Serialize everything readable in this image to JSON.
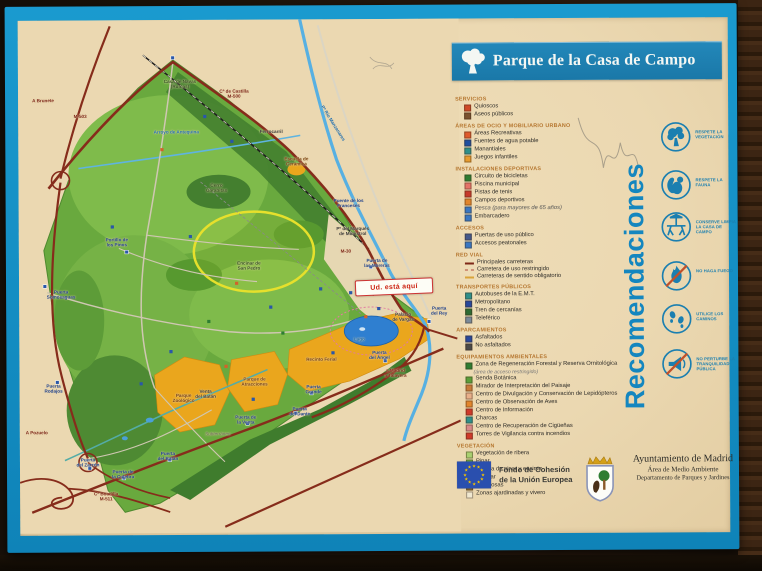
{
  "sign": {
    "title": "Parque de la Casa de Campo"
  },
  "you_are_here": "Ud. está aquí",
  "colors": {
    "frame_blue": "#1590c4",
    "panel_cream": "#ebd8b1",
    "banner_blue": "#1e7fb2",
    "park_green": "#69a93e",
    "park_dark_green": "#3f7c2d",
    "orange_zone": "#eaa61d",
    "road_maroon": "#862c1b",
    "river_blue": "#57b0e2",
    "lake_blue": "#2f7fd0",
    "bike_loop_yellow": "#e6e02c",
    "legend_header": "#b5762f",
    "recomendaciones_blue": "#1486bf"
  },
  "recommendations": {
    "heading": "Recomendaciones",
    "items": [
      {
        "icon": "tree-icon",
        "label": "RESPETE LA VEGETACIÓN"
      },
      {
        "icon": "squirrel-icon",
        "label": "RESPETE LA FAUNA"
      },
      {
        "icon": "picnic-table-icon",
        "label": "CONSERVE LIMPIA LA CASA DE CAMPO"
      },
      {
        "icon": "no-fire-icon",
        "label": "NO HAGA FUEGO"
      },
      {
        "icon": "footprints-icon",
        "label": "UTILICE LOS CAMINOS"
      },
      {
        "icon": "no-noise-icon",
        "label": "NO PERTURBE LA TRANQUILIDAD PÚBLICA"
      }
    ]
  },
  "legend": {
    "sections": [
      {
        "title": "SERVICIOS",
        "items": [
          {
            "label": "Quioscos",
            "color": "#cf4a28",
            "sw": "sq"
          },
          {
            "label": "Aseos públicos",
            "color": "#7a5230",
            "sw": "sq"
          }
        ]
      },
      {
        "title": "ÁREAS DE OCIO Y MOBILIARIO URBANO",
        "items": [
          {
            "label": "Áreas Recreativas",
            "color": "#df5a2c",
            "sw": "sq"
          },
          {
            "label": "Fuentes de agua potable",
            "color": "#1f4fa0",
            "sw": "sq"
          },
          {
            "label": "Manantiales",
            "color": "#2e8f8a",
            "sw": "sq"
          },
          {
            "label": "Juegos infantiles",
            "color": "#e79b2e",
            "sw": "sq"
          }
        ]
      },
      {
        "title": "INSTALACIONES DEPORTIVAS",
        "items": [
          {
            "label": "Circuito de bicicletas",
            "color": "#2e7d32",
            "sw": "sq"
          },
          {
            "label": "Piscina municipal",
            "color": "#e57368",
            "sw": "sq"
          },
          {
            "label": "Pistas de tenis",
            "color": "#c6392b",
            "sw": "sq"
          },
          {
            "label": "Campos deportivos",
            "color": "#e2862d",
            "sw": "sq"
          },
          {
            "label": "Pesca (para mayores de 65 años)",
            "color": "#3a77c2",
            "sw": "sq",
            "italic": true
          },
          {
            "label": "Embarcadero",
            "color": "#3a77c2",
            "sw": "sq"
          }
        ]
      },
      {
        "title": "ACCESOS",
        "items": [
          {
            "label": "Puertas de uso público",
            "color": "#44598c",
            "sw": "sq"
          },
          {
            "label": "Accesos peatonales",
            "color": "#3a77c2",
            "sw": "sq"
          }
        ]
      },
      {
        "title": "RED VIAL",
        "items": [
          {
            "label": "Principales carreteras",
            "color": "#7e2817",
            "sw": "line"
          },
          {
            "label": "Carretera de uso restringido",
            "color": "#b0483a",
            "sw": "dash"
          },
          {
            "label": "Carreteras de sentido obligatorio",
            "color": "#d9a43a",
            "sw": "line"
          }
        ]
      },
      {
        "title": "TRANSPORTES PÚBLICOS",
        "items": [
          {
            "label": "Autobuses de la E.M.T.",
            "color": "#2e8f8a",
            "sw": "sq"
          },
          {
            "label": "Metropolitano",
            "color": "#28489c",
            "sw": "sq"
          },
          {
            "label": "Tren de cercanías",
            "color": "#2e6b34",
            "sw": "sq"
          },
          {
            "label": "Teleférico",
            "color": "#7a8a9a",
            "sw": "sq"
          }
        ]
      },
      {
        "title": "APARCAMIENTOS",
        "items": [
          {
            "label": "Asfaltados",
            "color": "#28489c",
            "sw": "sq"
          },
          {
            "label": "No asfaltados",
            "color": "#4a4a4a",
            "sw": "sq"
          }
        ]
      },
      {
        "title": "EQUIPAMIENTOS AMBIENTALES",
        "items": [
          {
            "label": "Zona de Regeneración Forestal y Reserva Ornitológica",
            "sub": "(área de acceso restringido)",
            "color": "#2e7d32",
            "sw": "sq"
          },
          {
            "label": "Senda Botánica",
            "color": "#5a9e3a",
            "sw": "sq"
          },
          {
            "label": "Mirador de Interpretación del Paisaje",
            "color": "#c77a3a",
            "sw": "sq"
          },
          {
            "label": "Centro de Divulgación y Conservación de Lepidópteros",
            "color": "#e8b08a",
            "sw": "sq"
          },
          {
            "label": "Centro de Observación de Aves",
            "color": "#e2862d",
            "sw": "sq"
          },
          {
            "label": "Centro de Información",
            "color": "#cf3a2a",
            "sw": "sq"
          },
          {
            "label": "Charcas",
            "color": "#2e8f8a",
            "sw": "sq"
          },
          {
            "label": "Centro de Recuperación de Cigüeñas",
            "color": "#d88a8a",
            "sw": "sq"
          },
          {
            "label": "Torres de Vigilancia contra incendios",
            "color": "#cf3a2a",
            "sw": "sq"
          }
        ]
      },
      {
        "title": "VEGETACIÓN",
        "items": [
          {
            "label": "Vegetación de ribera",
            "color": "#a8d070",
            "sw": "sq"
          },
          {
            "label": "Pinar",
            "color": "#74b044",
            "sw": "sq"
          },
          {
            "label": "Mezcla de pinar y encinar",
            "color": "#549a38",
            "sw": "sq"
          },
          {
            "label": "Encinar",
            "color": "#2f7a2c",
            "sw": "sq"
          },
          {
            "label": "Frondosas",
            "color": "#8a6a2e",
            "sw": "sq"
          },
          {
            "label": "Zonas ajardinadas y vivero",
            "color": "#f0e8d0",
            "sw": "sq"
          }
        ]
      }
    ]
  },
  "map": {
    "labels": [
      {
        "t": "A Brunete",
        "x": 25,
        "y": 80,
        "c": "road"
      },
      {
        "t": "M-503",
        "x": 62,
        "y": 96,
        "c": "road"
      },
      {
        "t": "Cª de Castilla\nM-500",
        "x": 216,
        "y": 74,
        "c": "road"
      },
      {
        "t": "Casa de Navas\n(Ruinas)",
        "x": 162,
        "y": 64,
        "c": "area"
      },
      {
        "t": "Arroyo de Antequina",
        "x": 158,
        "y": 112,
        "c": "water"
      },
      {
        "t": "Ferrocarril",
        "x": 253,
        "y": 112,
        "c": "dark"
      },
      {
        "t": "Pª Río Manzanares",
        "x": 315,
        "y": 104,
        "c": "water",
        "r": 58
      },
      {
        "t": "Puente de los\nFranceses",
        "x": 330,
        "y": 184,
        "c": "gate"
      },
      {
        "t": "Pº del Marqués\nde Monistrol",
        "x": 334,
        "y": 212,
        "c": "dark"
      },
      {
        "t": "M-30",
        "x": 327,
        "y": 232,
        "c": "road"
      },
      {
        "t": "Puerta de\nlas Moreras",
        "x": 358,
        "y": 244,
        "c": "gate"
      },
      {
        "t": "Portillo de\nlos Pinos",
        "x": 98,
        "y": 222,
        "c": "gate"
      },
      {
        "t": "Puerta\nSomosaguas",
        "x": 42,
        "y": 274,
        "c": "gate"
      },
      {
        "t": "Encinar de\nSan Pedro",
        "x": 230,
        "y": 246,
        "c": "area"
      },
      {
        "t": "Cerro\nGarabitas",
        "x": 198,
        "y": 168,
        "c": "area"
      },
      {
        "t": "Escuela de\nCerámica",
        "x": 278,
        "y": 142,
        "c": "zone"
      },
      {
        "t": "Viveros\nMunicipales",
        "x": 352,
        "y": 272,
        "c": "dark"
      },
      {
        "t": "Palacio\nde Vargas",
        "x": 384,
        "y": 298,
        "c": "dark"
      },
      {
        "t": "Puerta\ndel Rey",
        "x": 420,
        "y": 292,
        "c": "gate"
      },
      {
        "t": "Lago",
        "x": 340,
        "y": 320,
        "c": "water"
      },
      {
        "t": "Puerta\ndel Ángel",
        "x": 360,
        "y": 336,
        "c": "gate"
      },
      {
        "t": "a Madrid\na Talavera",
        "x": 376,
        "y": 354,
        "c": "road"
      },
      {
        "t": "Parque\nZoológico",
        "x": 164,
        "y": 378,
        "c": "zone"
      },
      {
        "t": "Parque de\nAtracciones",
        "x": 235,
        "y": 362,
        "c": "zone"
      },
      {
        "t": "Recinto Ferial",
        "x": 302,
        "y": 340,
        "c": "zone"
      },
      {
        "t": "Puerta\nGrande",
        "x": 294,
        "y": 370,
        "c": "gate"
      },
      {
        "t": "Puerta\ndel Dante",
        "x": 280,
        "y": 392,
        "c": "gate"
      },
      {
        "t": "Puerta de\nla Venta",
        "x": 226,
        "y": 400,
        "c": "gate"
      },
      {
        "t": "Venta\ndel Batán",
        "x": 186,
        "y": 374,
        "c": "dark"
      },
      {
        "t": "Subterráneo",
        "x": 198,
        "y": 414,
        "c": "note"
      },
      {
        "t": "Puerta\ndel Batán",
        "x": 148,
        "y": 436,
        "c": "gate"
      },
      {
        "t": "Puerta\nRodajos",
        "x": 34,
        "y": 368,
        "c": "gate"
      },
      {
        "t": "Puerta\ndel Zarzón",
        "x": 68,
        "y": 442,
        "c": "gate"
      },
      {
        "t": "Puerta de\nla Culebra",
        "x": 103,
        "y": 454,
        "c": "gate"
      },
      {
        "t": "A Pozuelo",
        "x": 17,
        "y": 412,
        "c": "road"
      },
      {
        "t": "Cª Boadilla\nM-511",
        "x": 86,
        "y": 476,
        "c": "road"
      }
    ]
  },
  "footer": {
    "eu": {
      "line1": "Fondo de Cohesión",
      "line2": "de la Unión Europea"
    },
    "madrid": {
      "line1": "Ayuntamiento de Madrid",
      "line2": "Área de Medio Ambiente",
      "line3": "Departamento de Parques y Jardines"
    }
  }
}
